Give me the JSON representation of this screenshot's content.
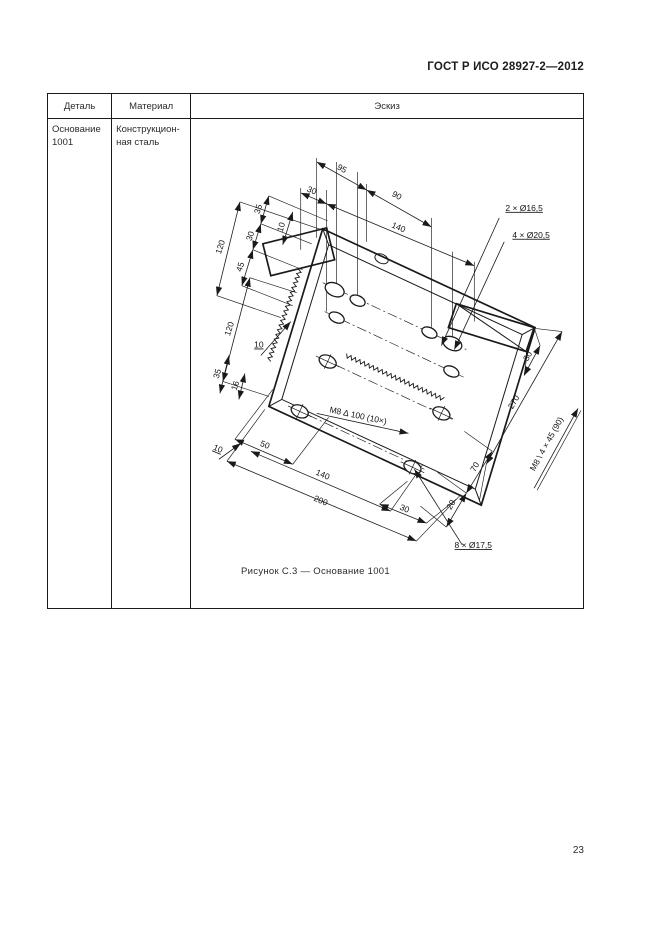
{
  "page": {
    "header_title": "ГОСТ Р ИСО 28927-2—2012",
    "caption": "Рисунок С.3 — Основание 1001",
    "page_number": "23"
  },
  "table": {
    "headers": {
      "detail": "Деталь",
      "material": "Материал",
      "sketch": "Эскиз"
    },
    "row": {
      "detail": "Основание\n1001",
      "material": "Конструкцион-\nная сталь"
    }
  },
  "sketch": {
    "part_name": "Основание 1001",
    "line_color": "#1a1a1a",
    "labels": [
      {
        "t": "95",
        "x": 146,
        "y": 21,
        "r": 29
      },
      {
        "t": "30",
        "x": 116,
        "y": 43,
        "r": 23
      },
      {
        "t": "90",
        "x": 201,
        "y": 48,
        "r": 29
      },
      {
        "t": "140",
        "x": 203,
        "y": 80,
        "r": 23
      },
      {
        "t": "2 × Ø16,5",
        "x": 330,
        "y": 61,
        "r": 0,
        "u": 1
      },
      {
        "t": "4 × Ø20,5",
        "x": 337,
        "y": 88,
        "r": 0,
        "u": 1
      },
      {
        "t": "120",
        "x": 28,
        "y": 98,
        "r": -72
      },
      {
        "t": "35",
        "x": 66,
        "y": 60,
        "r": -72
      },
      {
        "t": "30",
        "x": 58,
        "y": 87,
        "r": -72
      },
      {
        "t": "10",
        "x": 89,
        "y": 78,
        "r": -72
      },
      {
        "t": "45",
        "x": 48,
        "y": 118,
        "r": -72
      },
      {
        "t": "120",
        "x": 37,
        "y": 180,
        "r": -72
      },
      {
        "t": "10",
        "x": 64,
        "y": 198,
        "r": 0,
        "u": 1
      },
      {
        "t": "35",
        "x": 25,
        "y": 225,
        "r": -72
      },
      {
        "t": "16",
        "x": 43,
        "y": 237,
        "r": -72
      },
      {
        "t": "10",
        "x": 22,
        "y": 302,
        "r": 23,
        "u": 1
      },
      {
        "t": "50",
        "x": 69,
        "y": 298,
        "r": 23
      },
      {
        "t": "140",
        "x": 127,
        "y": 328,
        "r": 23
      },
      {
        "t": "200",
        "x": 125,
        "y": 354,
        "r": 23
      },
      {
        "t": "30",
        "x": 209,
        "y": 362,
        "r": 23
      },
      {
        "t": "8 × Ø17,5",
        "x": 279,
        "y": 399,
        "r": 0,
        "u": 1
      },
      {
        "t": "20",
        "x": 259,
        "y": 357,
        "r": -60
      },
      {
        "t": "70",
        "x": 283,
        "y": 319,
        "r": -60
      },
      {
        "t": "30",
        "x": 336,
        "y": 208,
        "r": -60
      },
      {
        "t": "270",
        "x": 322,
        "y": 254,
        "r": -60
      },
      {
        "t": "M8 \\ 4 × 45 (90)",
        "x": 355,
        "y": 296,
        "r": -61
      },
      {
        "t": "M8 ∆ 100 (10×)",
        "x": 163,
        "y": 269,
        "r": 12
      }
    ]
  }
}
